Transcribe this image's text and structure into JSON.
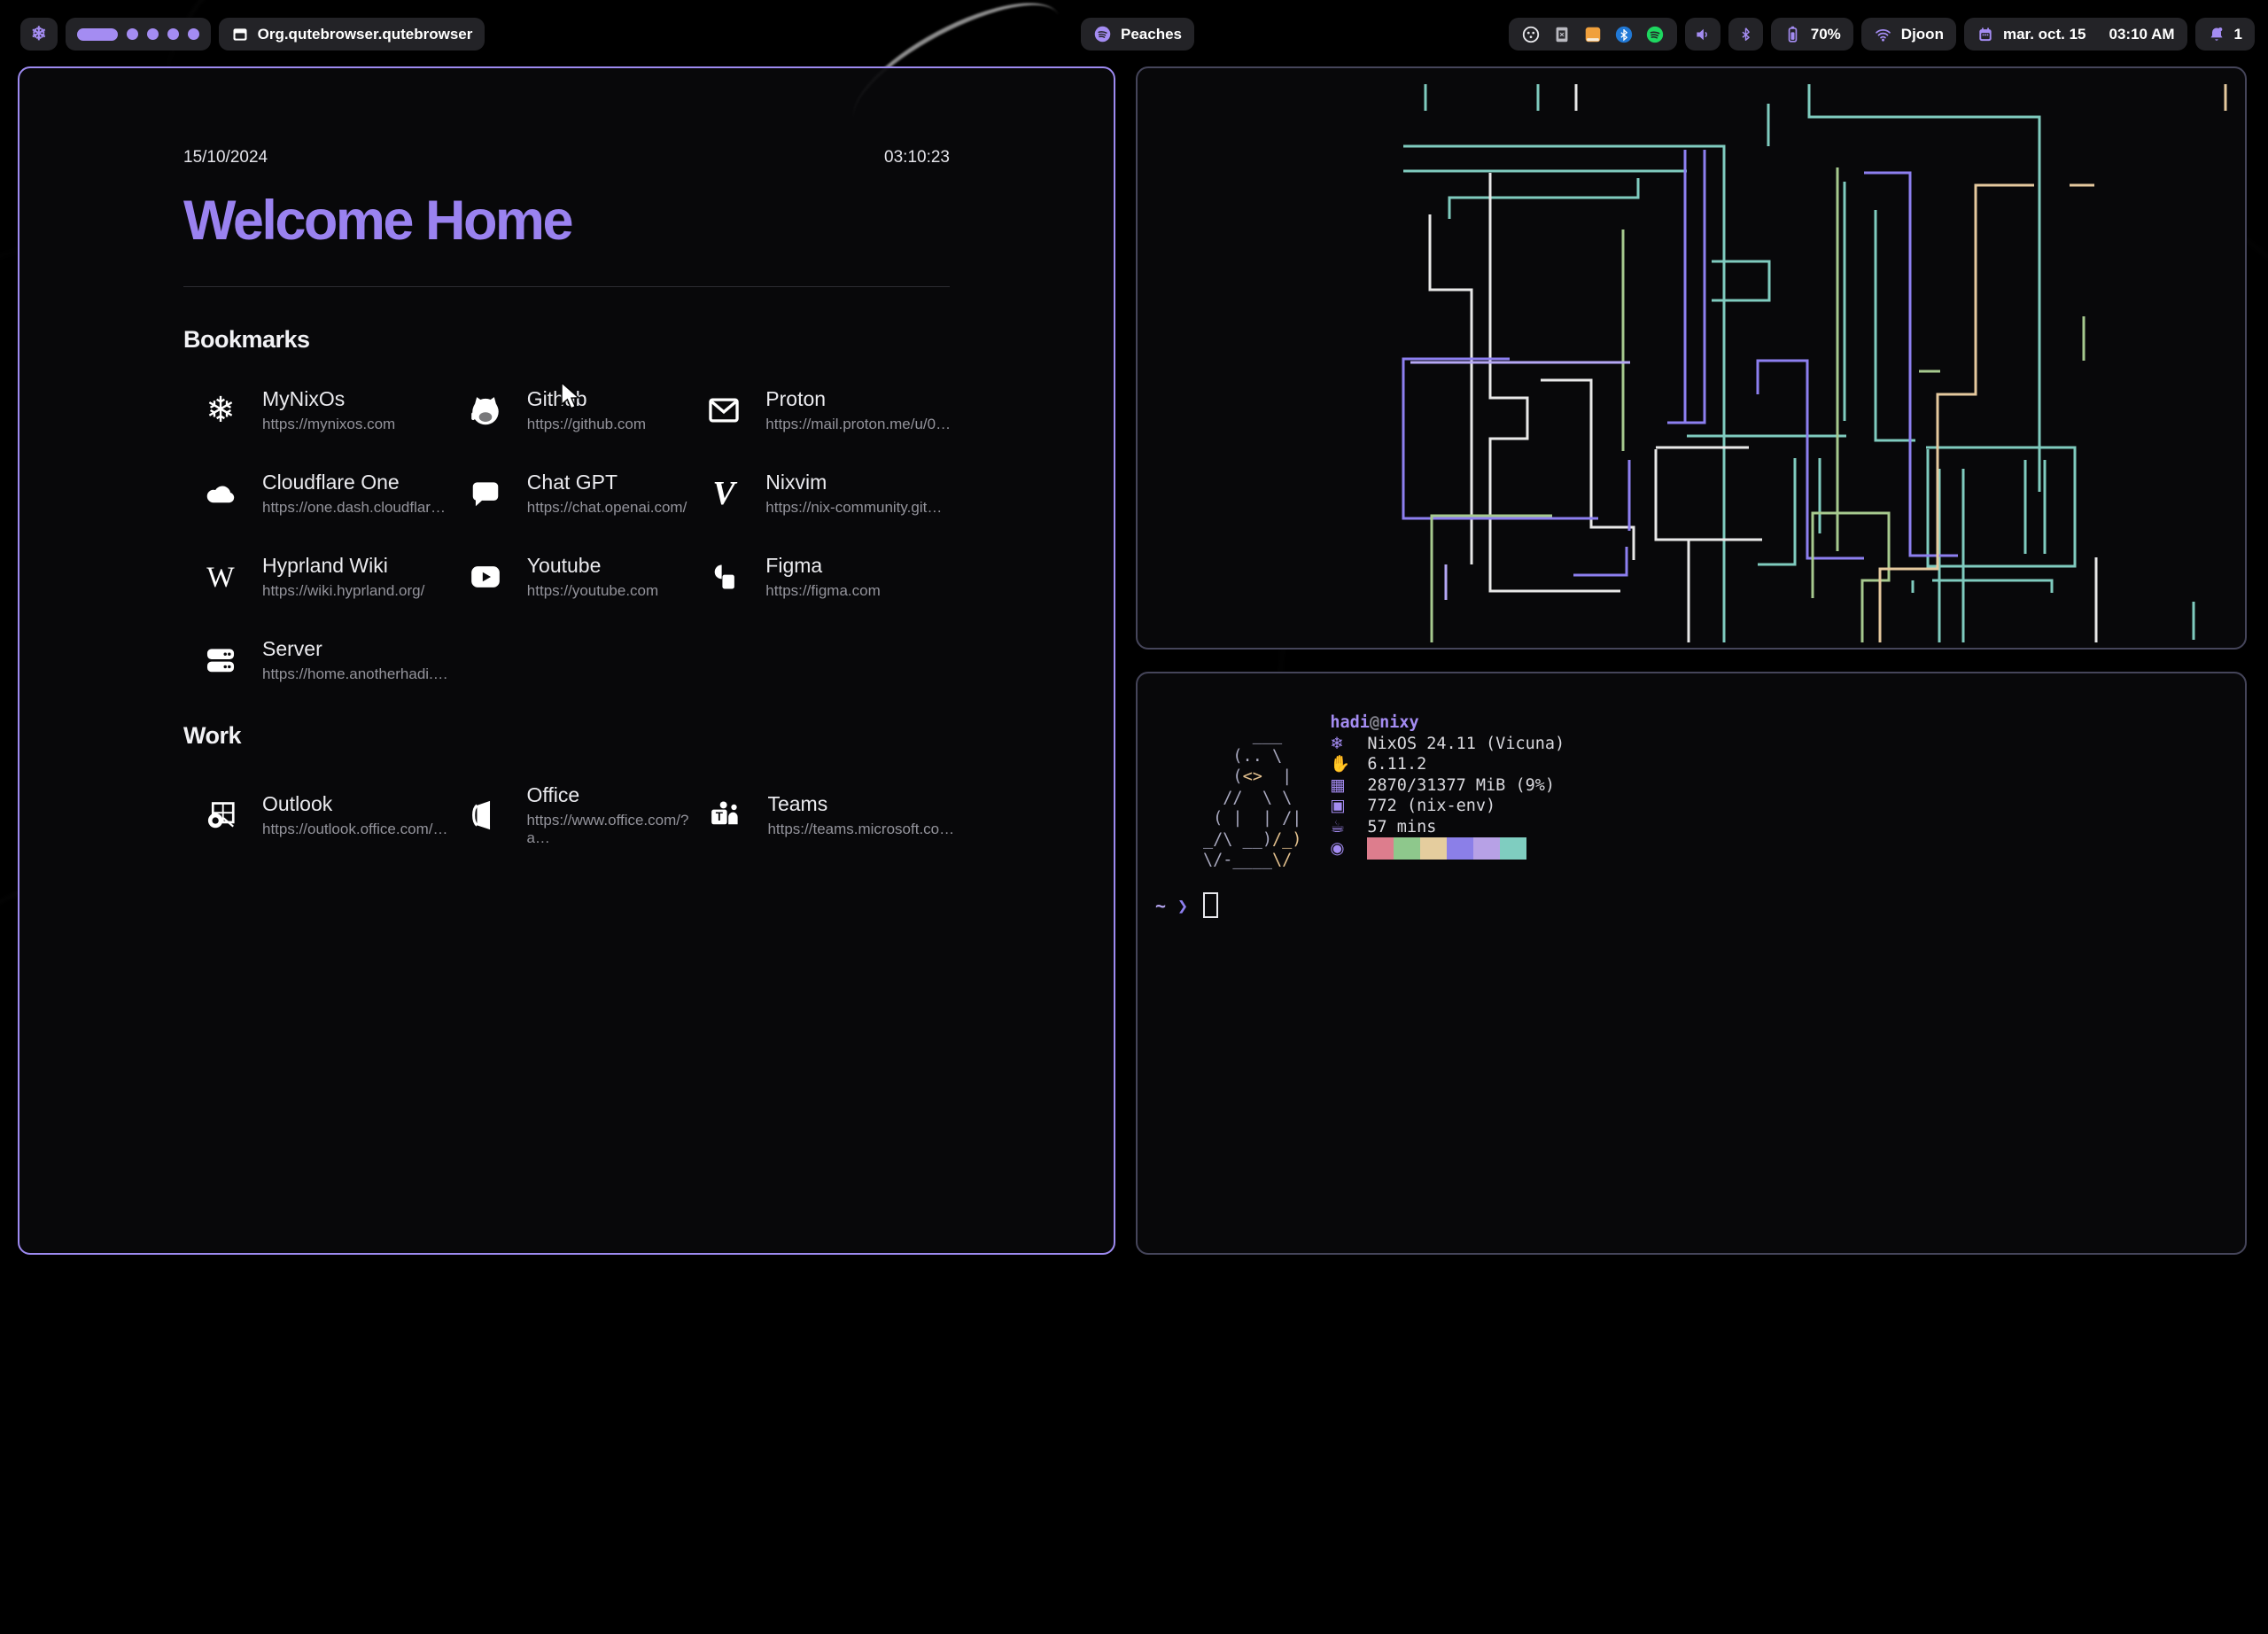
{
  "colors": {
    "accent": "#a48cf2",
    "active_border": "#9d8af0",
    "inactive_border": "#45455a",
    "pipe_palette": [
      "#7fcbbf",
      "#e8e8e8",
      "#8d7ff0",
      "#a6c98e",
      "#e5c99e",
      "#b5a7f5"
    ],
    "spotify_green": "#1ed760",
    "bluetooth_blue": "#2179d6",
    "files_orange": "#f0a03c"
  },
  "bar": {
    "workspaces": {
      "active": 1,
      "total": 5
    },
    "window_title": "Org.qutebrowser.qutebrowser",
    "media": {
      "label": "Peaches"
    },
    "tray_icons": [
      "disc",
      "keyboard",
      "files",
      "bluetooth-tray",
      "spotify-green"
    ],
    "battery": {
      "percent": "70%"
    },
    "wifi": {
      "ssid": "Djoon"
    },
    "clock": {
      "date": "mar. oct. 15",
      "time": "03:10 AM"
    },
    "notifications": {
      "count": "1"
    }
  },
  "startpage": {
    "date": "15/10/2024",
    "time": "03:10:23",
    "title": "Welcome Home",
    "sections": [
      {
        "heading": "Bookmarks",
        "items": [
          {
            "icon": "nixos",
            "title": "MyNixOs",
            "url": "https://mynixos.com"
          },
          {
            "icon": "github",
            "title": "Github",
            "url": "https://github.com"
          },
          {
            "icon": "mail",
            "title": "Proton",
            "url": "https://mail.proton.me/u/0…"
          },
          {
            "icon": "cloud",
            "title": "Cloudflare One",
            "url": "https://one.dash.cloudflar…"
          },
          {
            "icon": "chat",
            "title": "Chat GPT",
            "url": "https://chat.openai.com/"
          },
          {
            "icon": "nixvim",
            "title": "Nixvim",
            "url": "https://nix-community.git…"
          },
          {
            "icon": "wiki",
            "title": "Hyprland Wiki",
            "url": "https://wiki.hyprland.org/"
          },
          {
            "icon": "youtube",
            "title": "Youtube",
            "url": "https://youtube.com"
          },
          {
            "icon": "figma",
            "title": "Figma",
            "url": "https://figma.com"
          },
          {
            "icon": "server",
            "title": "Server",
            "url": "https://home.anotherhadi.…"
          }
        ]
      },
      {
        "heading": "Work",
        "items": [
          {
            "icon": "outlook",
            "title": "Outlook",
            "url": "https://outlook.office.com/…"
          },
          {
            "icon": "office",
            "title": "Office",
            "url": "https://www.office.com/?a…"
          },
          {
            "icon": "teams",
            "title": "Teams",
            "url": "https://teams.microsoft.co…"
          }
        ]
      }
    ]
  },
  "pipes": {
    "stroke": 3,
    "paths": [
      {
        "c": 0,
        "p": "325,18 325,48"
      },
      {
        "c": 0,
        "p": "452,18 452,48"
      },
      {
        "c": 0,
        "p": "300,88 662,88 662,648"
      },
      {
        "c": 0,
        "p": "300,116 620,116"
      },
      {
        "c": 0,
        "p": "352,170 352,146 565,146 565,124"
      },
      {
        "c": 0,
        "p": "648,218 713,218 713,262 648,262"
      },
      {
        "c": 0,
        "p": "712,40 712,88"
      },
      {
        "c": 0,
        "p": "758,18 758,55 1018,55 1018,478"
      },
      {
        "c": 0,
        "p": "798,128 798,398"
      },
      {
        "c": 0,
        "p": "833,160 833,420 878,420"
      },
      {
        "c": 0,
        "p": "620,415 800,415"
      },
      {
        "c": 0,
        "p": "742,440 742,560 700,560"
      },
      {
        "c": 0,
        "p": "770,440 770,525"
      },
      {
        "c": 0,
        "p": "905,452 905,648"
      },
      {
        "c": 0,
        "p": "932,452 932,648"
      },
      {
        "c": 0,
        "p": "890,428 1058,428 1058,562 892,562 892,430"
      },
      {
        "c": 0,
        "p": "1002,442 1002,548"
      },
      {
        "c": 0,
        "p": "1024,442 1024,548"
      },
      {
        "c": 0,
        "p": "875,578 875,592"
      },
      {
        "c": 0,
        "p": "897,578 1032,578 1032,592"
      },
      {
        "c": 0,
        "p": "1192,602 1192,645"
      },
      {
        "c": 1,
        "p": "495,18 495,48"
      },
      {
        "c": 1,
        "p": "398,118 398,372 440,372 440,418 398,418 398,590 545,590"
      },
      {
        "c": 1,
        "p": "330,165 330,250 377,250 377,560"
      },
      {
        "c": 1,
        "p": "455,352 512,352 512,518 560,518 560,555"
      },
      {
        "c": 1,
        "p": "585,428 690,428"
      },
      {
        "c": 1,
        "p": "585,430 585,532 705,532"
      },
      {
        "c": 1,
        "p": "622,532 622,648"
      },
      {
        "c": 1,
        "p": "1082,552 1082,648"
      },
      {
        "c": 2,
        "p": "618,92 618,400"
      },
      {
        "c": 2,
        "p": "640,92 640,400 598,400"
      },
      {
        "c": 2,
        "p": "420,328 300,328 300,508 520,508"
      },
      {
        "c": 2,
        "p": "700,368 700,330 756,330 756,553 820,553"
      },
      {
        "c": 2,
        "p": "820,118 872,118 872,550 926,550"
      },
      {
        "c": 2,
        "p": "555,442 555,522"
      },
      {
        "c": 2,
        "p": "492,572 552,572 552,540"
      },
      {
        "c": 3,
        "p": "548,182 548,432"
      },
      {
        "c": 3,
        "p": "790,112 790,545"
      },
      {
        "c": 3,
        "p": "332,648 332,505 468,505"
      },
      {
        "c": 3,
        "p": "762,598 762,502 848,502 848,578 818,578 818,648"
      },
      {
        "c": 3,
        "p": "882,342 906,342"
      },
      {
        "c": 3,
        "p": "1068,280 1068,330"
      },
      {
        "c": 4,
        "p": "1228,18 1228,48"
      },
      {
        "c": 4,
        "p": "1052,132 1080,132"
      },
      {
        "c": 4,
        "p": "1012,132 946,132 946,368 903,368 903,565 838,565 838,648"
      },
      {
        "c": 5,
        "p": "308,332 556,332"
      },
      {
        "c": 5,
        "p": "348,600 348,560"
      }
    ]
  },
  "fastfetch": {
    "user": "hadi",
    "at": "@",
    "host": "nixy",
    "art": [
      [
        [
          "g",
          "     ___ "
        ]
      ],
      [
        [
          "g",
          "   (.. \\ "
        ]
      ],
      [
        [
          "g",
          "   ("
        ],
        [
          "t",
          "<>"
        ],
        [
          "g",
          "  |"
        ]
      ],
      [
        [
          "g",
          "  //  \\ \\"
        ]
      ],
      [
        [
          "g",
          " ( |  | /|"
        ]
      ],
      [
        [
          "g",
          "_/\\ __)"
        ],
        [
          "t",
          "/_)"
        ]
      ],
      [
        [
          "g",
          "\\/-____"
        ],
        [
          "t",
          "\\/"
        ]
      ]
    ],
    "rows": [
      {
        "icon_name": "os-snowflake-icon",
        "glyph": "❄",
        "label": "NixOS 24.11 (Vicuna)"
      },
      {
        "icon_name": "kernel-icon",
        "glyph": "✋",
        "label": "6.11.2"
      },
      {
        "icon_name": "memory-icon",
        "glyph": "▦",
        "label": "2870/31377 MiB (9%)"
      },
      {
        "icon_name": "packages-icon",
        "glyph": "▣",
        "label": "772 (nix-env)"
      },
      {
        "icon_name": "uptime-icon",
        "glyph": "☕",
        "label": "57 mins"
      }
    ],
    "palette": [
      "#dd7d8d",
      "#8ec88c",
      "#e5cd9e",
      "#8b7fe8",
      "#b7a1e6",
      "#7fcdc0"
    ],
    "palette_icon_glyph": "◉",
    "prompt": {
      "cwd": "~",
      "symbol": "❯"
    }
  }
}
